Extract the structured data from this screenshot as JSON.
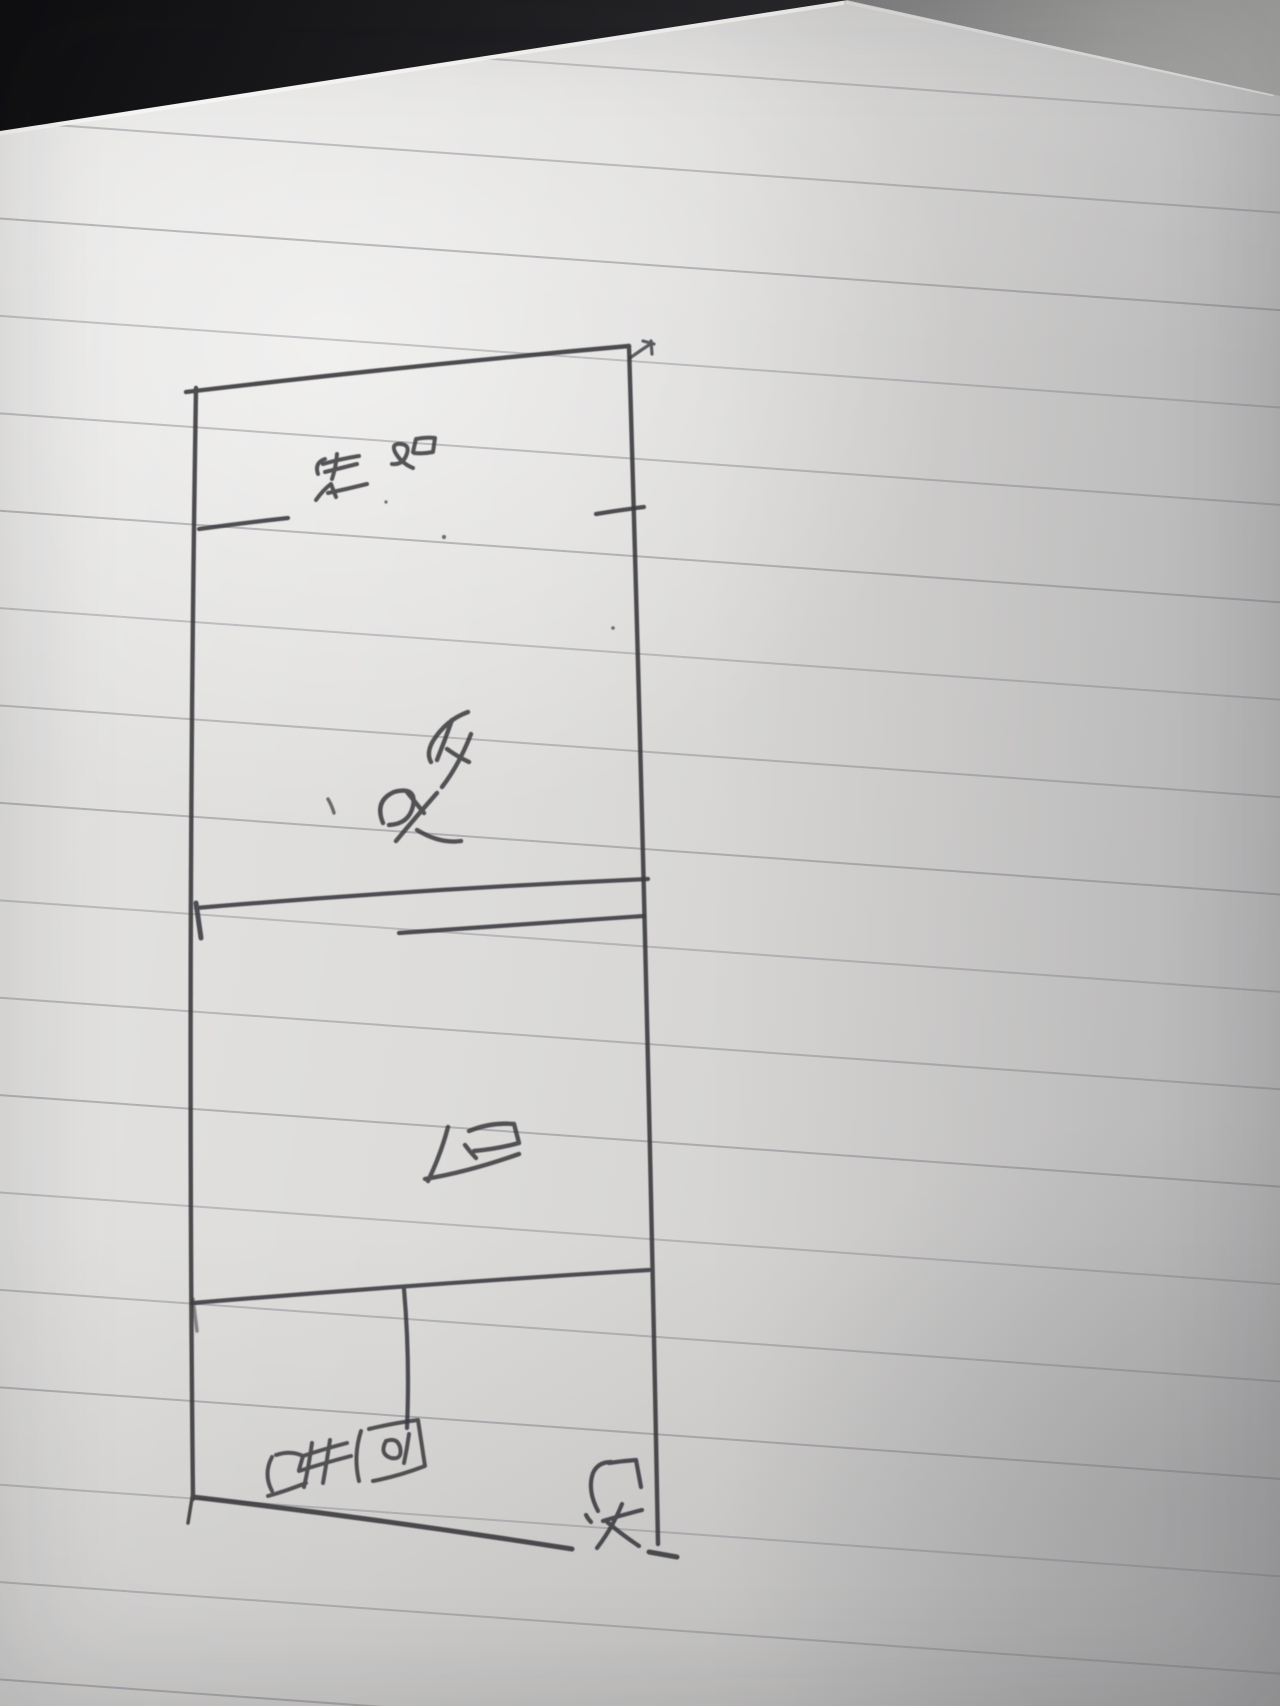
{
  "photo": {
    "description": "Photograph of a hand-drawn apartment floor plan sketched in pen on ruled notebook paper; the drawing and handwriting are rotated 90 degrees (read by turning the page clockwise)",
    "paper_color": "#dbdad8",
    "ruled_line_color": "#70707a",
    "ink_color": "#3a3a3e",
    "desk_dark_color": "#141416",
    "desk_gray_color": "#9c9c9a"
  },
  "floor_plan": {
    "rooms": [
      {
        "id": "balcony",
        "text": "阳台"
      },
      {
        "id": "bedroom",
        "text": "卧室"
      },
      {
        "id": "hall",
        "text": "厅"
      },
      {
        "id": "bathroom",
        "text": "卫生间"
      },
      {
        "id": "main-door",
        "text": "大门"
      }
    ]
  }
}
